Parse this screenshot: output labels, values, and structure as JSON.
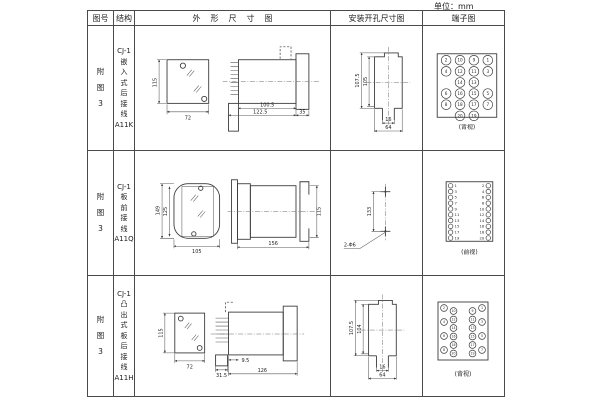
{
  "unit_label": "单位：mm",
  "headers": {
    "fig_no": "图号",
    "structure": "结构",
    "outline": "外形尺寸图",
    "mounting": "安装开孔尺寸图",
    "terminal": "端子图"
  },
  "rows": [
    {
      "fig_no": "附\n图\n3",
      "structure": "CJ-1\n嵌\n入\n式\n后\n接\n线\nA11K",
      "outline_dims": {
        "front_height": "115",
        "front_width": "72",
        "body_width": "100.5",
        "total_width": "122.5",
        "flange_width": "35"
      },
      "mounting_dims": {
        "outer_height": "107.5",
        "inner_height": "105",
        "slot_width": "16",
        "opening_width": "64"
      },
      "terminal": {
        "view_label": "(背视)",
        "grid": [
          [
            "2",
            "10",
            "9",
            "1"
          ],
          [
            "4",
            "12",
            "11",
            "3"
          ],
          [
            "",
            "14",
            "13",
            ""
          ],
          [
            "6",
            "16",
            "15",
            "5"
          ],
          [
            "8",
            "18",
            "17",
            "7"
          ],
          [
            "",
            "20",
            "19",
            ""
          ]
        ]
      }
    },
    {
      "fig_no": "附\n图\n3",
      "structure": "CJ-1\n板\n前\n接\n线\nA11Q",
      "outline_dims": {
        "front_height": "149",
        "inner_height": "125",
        "front_width": "105",
        "side_length": "156",
        "side_height": "115"
      },
      "mounting_dims": {
        "hole_spacing": "133",
        "holes": "2-Φ6"
      },
      "terminal": {
        "view_label": "(前视)",
        "left_col": [
          "1",
          "3",
          "5",
          "7",
          "9",
          "11",
          "13",
          "15",
          "17",
          "19"
        ],
        "right_col": [
          "2",
          "4",
          "6",
          "8",
          "10",
          "12",
          "14",
          "16",
          "18",
          "20"
        ]
      }
    },
    {
      "fig_no": "附\n图\n3",
      "structure": "CJ-1\n凸\n出\n式\n板\n后\n接\n线\nA11H",
      "outline_dims": {
        "front_height": "115",
        "front_width": "72",
        "base_width": "31.5",
        "offset": "9.5",
        "total_length": "126"
      },
      "mounting_dims": {
        "outer_height": "107.5",
        "inner_height": "104",
        "slot_width": "16",
        "opening_width": "64"
      },
      "terminal": {
        "view_label": "(背视)",
        "columns": {
          "outer_left": [
            "2",
            "4",
            "6",
            "8"
          ],
          "inner_left": [
            "10",
            "12",
            "14",
            "16",
            "18",
            "20"
          ],
          "inner_right": [
            "9",
            "11",
            "13",
            "15",
            "17",
            "19"
          ],
          "outer_right": [
            "1",
            "3",
            "5",
            "7"
          ]
        }
      }
    }
  ]
}
